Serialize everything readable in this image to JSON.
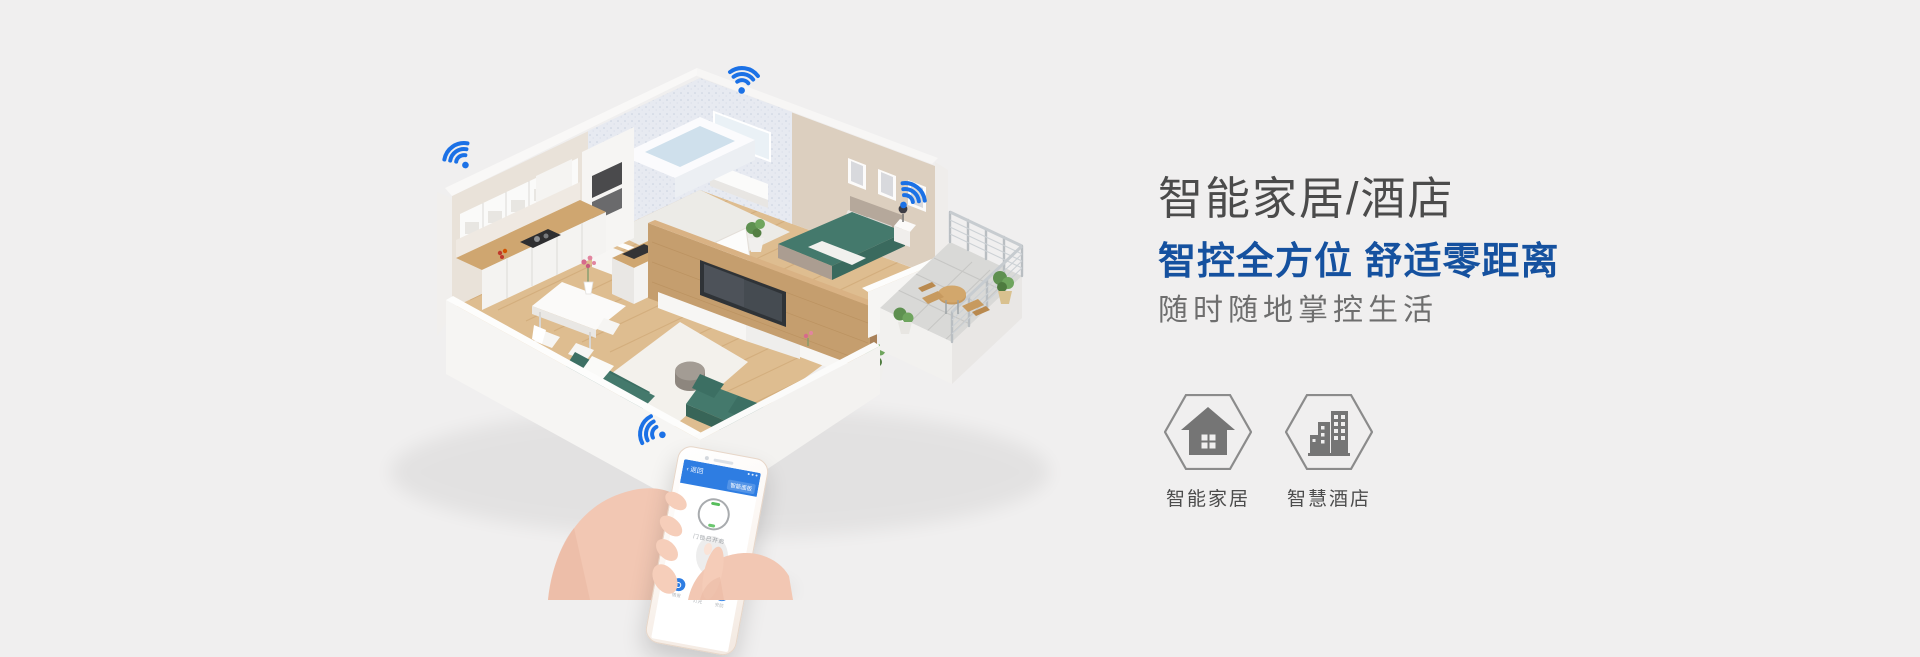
{
  "page": {
    "background_color": "#f0efef"
  },
  "hero": {
    "title": "智能家居/酒店",
    "subtitle": "智控全方位 舒适零距离",
    "tagline": "随时随地掌控生活",
    "title_color": "#4b4b4b",
    "subtitle_color": "#15519f",
    "tagline_color": "#6e6e6e"
  },
  "features": [
    {
      "label": "智能家居",
      "icon": "home-icon"
    },
    {
      "label": "智慧酒店",
      "icon": "hotel-buildings-icon"
    }
  ],
  "phone_app": {
    "back_label": "‹ 返回",
    "menu_label": "智能面板",
    "dial_caption": "门锁已开启",
    "buttons": [
      "情景",
      "灯光",
      "安防"
    ]
  },
  "illustration": {
    "wifi_color": "#1b71e6",
    "wifi_hotspots": 4,
    "furniture_accent_color": "#44796c",
    "floor_color": "#debd90"
  }
}
